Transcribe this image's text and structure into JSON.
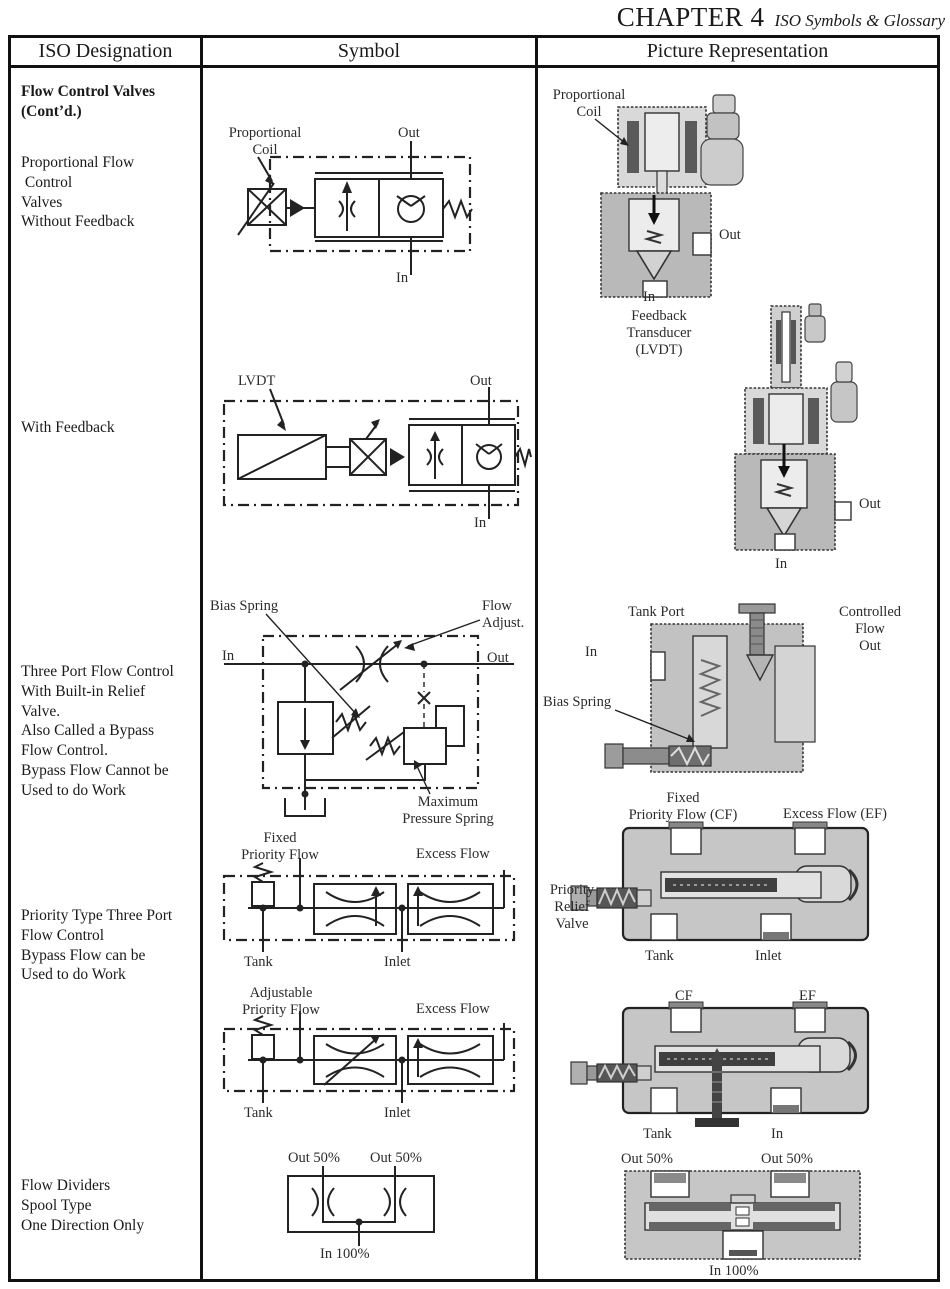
{
  "page_header": {
    "chapter": "CHAPTER 4",
    "subtitle": "ISO Symbols & Glossary"
  },
  "table_headers": {
    "designation": "ISO Designation",
    "symbol": "Symbol",
    "picture": "Picture Representation"
  },
  "designation_column": {
    "section_title": "Flow Control Valves\n(Cont’d.)",
    "proportional_no_feedback": "Proportional Flow\n Control\nValves\nWithout Feedback",
    "with_feedback": "With Feedback",
    "three_port": "Three Port Flow Control\nWith Built-in Relief\nValve.\nAlso Called a Bypass\nFlow Control.\nBypass Flow Cannot be\nUsed to do Work",
    "priority_type": "Priority Type Three Port\nFlow Control\nBypass Flow can be\nUsed to do Work",
    "flow_dividers": "Flow Dividers\nSpool Type\nOne Direction Only"
  },
  "symbol_column": {
    "proportional": {
      "coil": "Proportional\nCoil",
      "out": "Out",
      "in": "In"
    },
    "feedback": {
      "lvdt": "LVDT",
      "out": "Out",
      "in": "In"
    },
    "three_port": {
      "bias_spring": "Bias Spring",
      "in": "In",
      "flow_adjust": "Flow\nAdjust.",
      "out": "Out",
      "max_pressure_spring": "Maximum\nPressure Spring"
    },
    "fixed_priority": {
      "priority_flow": "Fixed\nPriority Flow",
      "excess_flow": "Excess Flow",
      "tank": "Tank",
      "inlet": "Inlet"
    },
    "adjustable_priority": {
      "priority_flow": "Adjustable\nPriority Flow",
      "excess_flow": "Excess Flow",
      "tank": "Tank",
      "inlet": "Inlet"
    },
    "flow_divider": {
      "out_left": "Out 50%",
      "out_right": "Out 50%",
      "in": "In 100%"
    }
  },
  "picture_column": {
    "proportional": {
      "coil": "Proportional\nCoil",
      "out": "Out",
      "in": "In"
    },
    "feedback": {
      "transducer": "Feedback\nTransducer\n(LVDT)",
      "out": "Out",
      "in": "In"
    },
    "three_port": {
      "tank_port": "Tank Port",
      "controlled_flow": "Controlled\nFlow\nOut",
      "in": "In",
      "bias_spring": "Bias Spring"
    },
    "fixed_priority": {
      "priority_flow": "Fixed\nPriority Flow (CF)",
      "excess_flow": "Excess Flow (EF)",
      "relief_valve": "Priority\nRelief\nValve",
      "tank": "Tank",
      "inlet": "Inlet"
    },
    "adjustable_priority": {
      "cf": "CF",
      "ef": "EF",
      "tank": "Tank",
      "in": "In"
    },
    "flow_divider": {
      "out_left": "Out 50%",
      "out_right": "Out 50%",
      "in": "In 100%"
    }
  },
  "colors": {
    "ink": "#222222",
    "body_gray": "#c4c4c4",
    "light_gray": "#dcdcdc",
    "dark_gray": "#5a5a5a"
  }
}
